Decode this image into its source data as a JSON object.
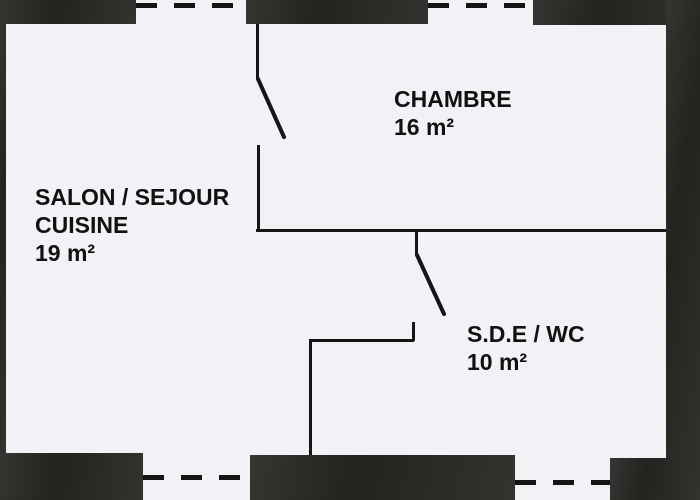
{
  "title": "Apartment floor plan",
  "colors": {
    "background": "#f2f1f5",
    "wall": "#2c2a27",
    "line": "#151515",
    "text": "#111111"
  },
  "rooms": [
    {
      "id": "salon-sejour-cuisine",
      "lines": [
        "SALON / SEJOUR",
        "CUISINE"
      ],
      "area": "19 m²"
    },
    {
      "id": "chambre",
      "lines": [
        "CHAMBRE"
      ],
      "area": "16 m²"
    },
    {
      "id": "sde-wc",
      "lines": [
        "S.D.E / WC"
      ],
      "area": "10 m²"
    }
  ]
}
